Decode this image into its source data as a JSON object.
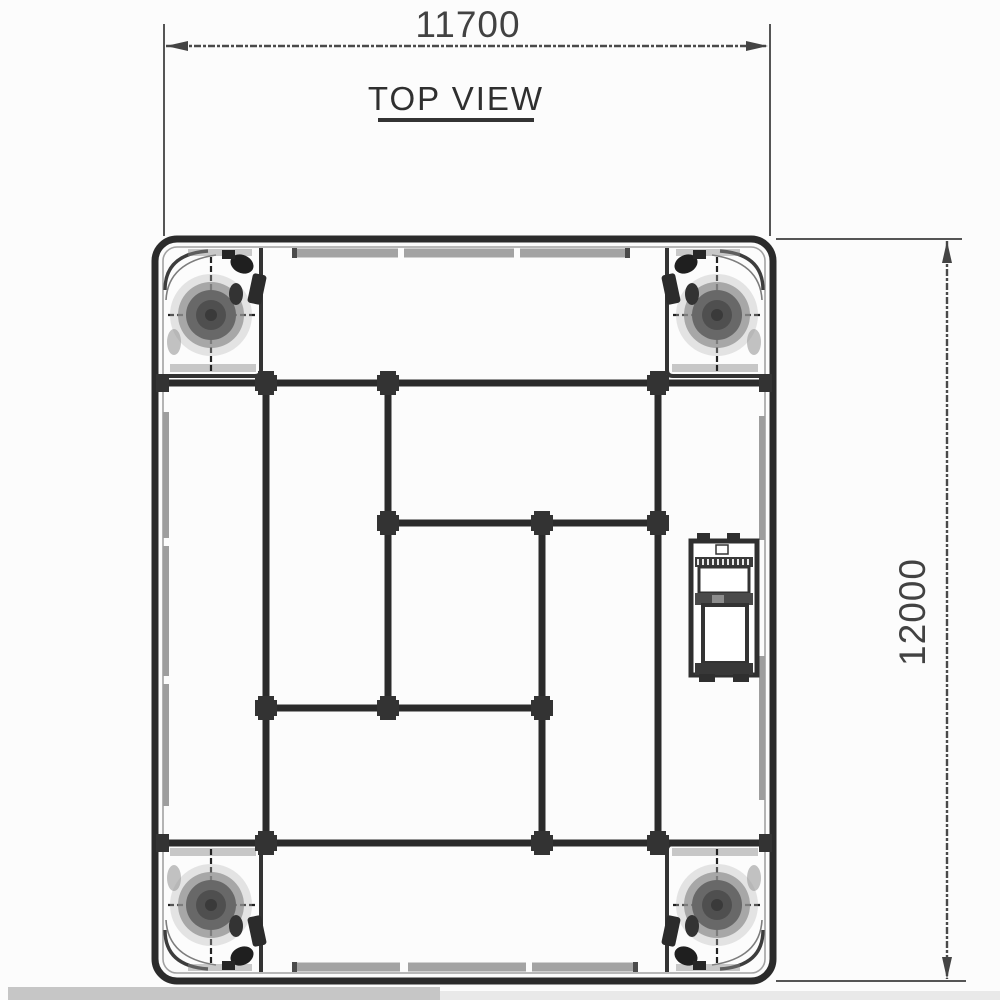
{
  "drawing": {
    "title": "TOP VIEW",
    "dimensions": {
      "width_label": "11700",
      "height_label": "12000"
    },
    "colors": {
      "line": "#2b2b2b",
      "dimension_line": "#4a4a4a",
      "rail_gray": "#9e9e9e",
      "strip_gray": "#a3a3a3",
      "text": "#3a3a3a",
      "background": "#fcfcfc"
    }
  }
}
